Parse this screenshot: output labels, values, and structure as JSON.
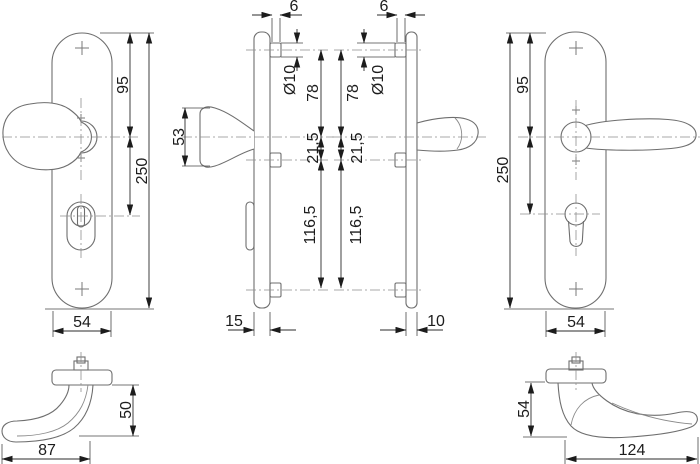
{
  "drawing": {
    "kind": "technical-drawing",
    "subject": "Security door fitting set: knob backplate, lever backplate, side profiles and grip top views",
    "background_color": "#ffffff",
    "line_color": "#6e6e6e",
    "dimension_color": "#2b2b2b",
    "views": {
      "knob_plate_front": {
        "label": "knob backplate front view",
        "dims": {
          "top_to_knob": "95",
          "plate_height": "250",
          "plate_width": "54"
        }
      },
      "knob_side_profile": {
        "label": "knob backplate side view",
        "dims": {
          "screw_protrusion": "6",
          "screw_diameter": "Ø10",
          "top_screw_to_knob": "78",
          "knob_height": "53",
          "knob_to_mid_screw": "21,5",
          "mid_to_bottom_screw": "116,5",
          "plate_depth": "15"
        }
      },
      "lever_side_profile": {
        "label": "lever backplate side view",
        "dims": {
          "screw_protrusion": "6",
          "screw_diameter": "Ø10",
          "top_screw_to_lever": "78",
          "lever_to_mid_screw": "21,5",
          "mid_to_bottom_screw": "116,5",
          "plate_depth": "10"
        }
      },
      "lever_plate_front": {
        "label": "lever backplate front view",
        "dims": {
          "top_to_lever": "95",
          "plate_height": "250",
          "plate_width": "54"
        }
      },
      "knob_top_view": {
        "label": "knob grip top view",
        "dims": {
          "projection": "50",
          "length": "87"
        }
      },
      "lever_top_view": {
        "label": "lever grip top view",
        "dims": {
          "projection": "54",
          "length": "124"
        }
      }
    }
  }
}
